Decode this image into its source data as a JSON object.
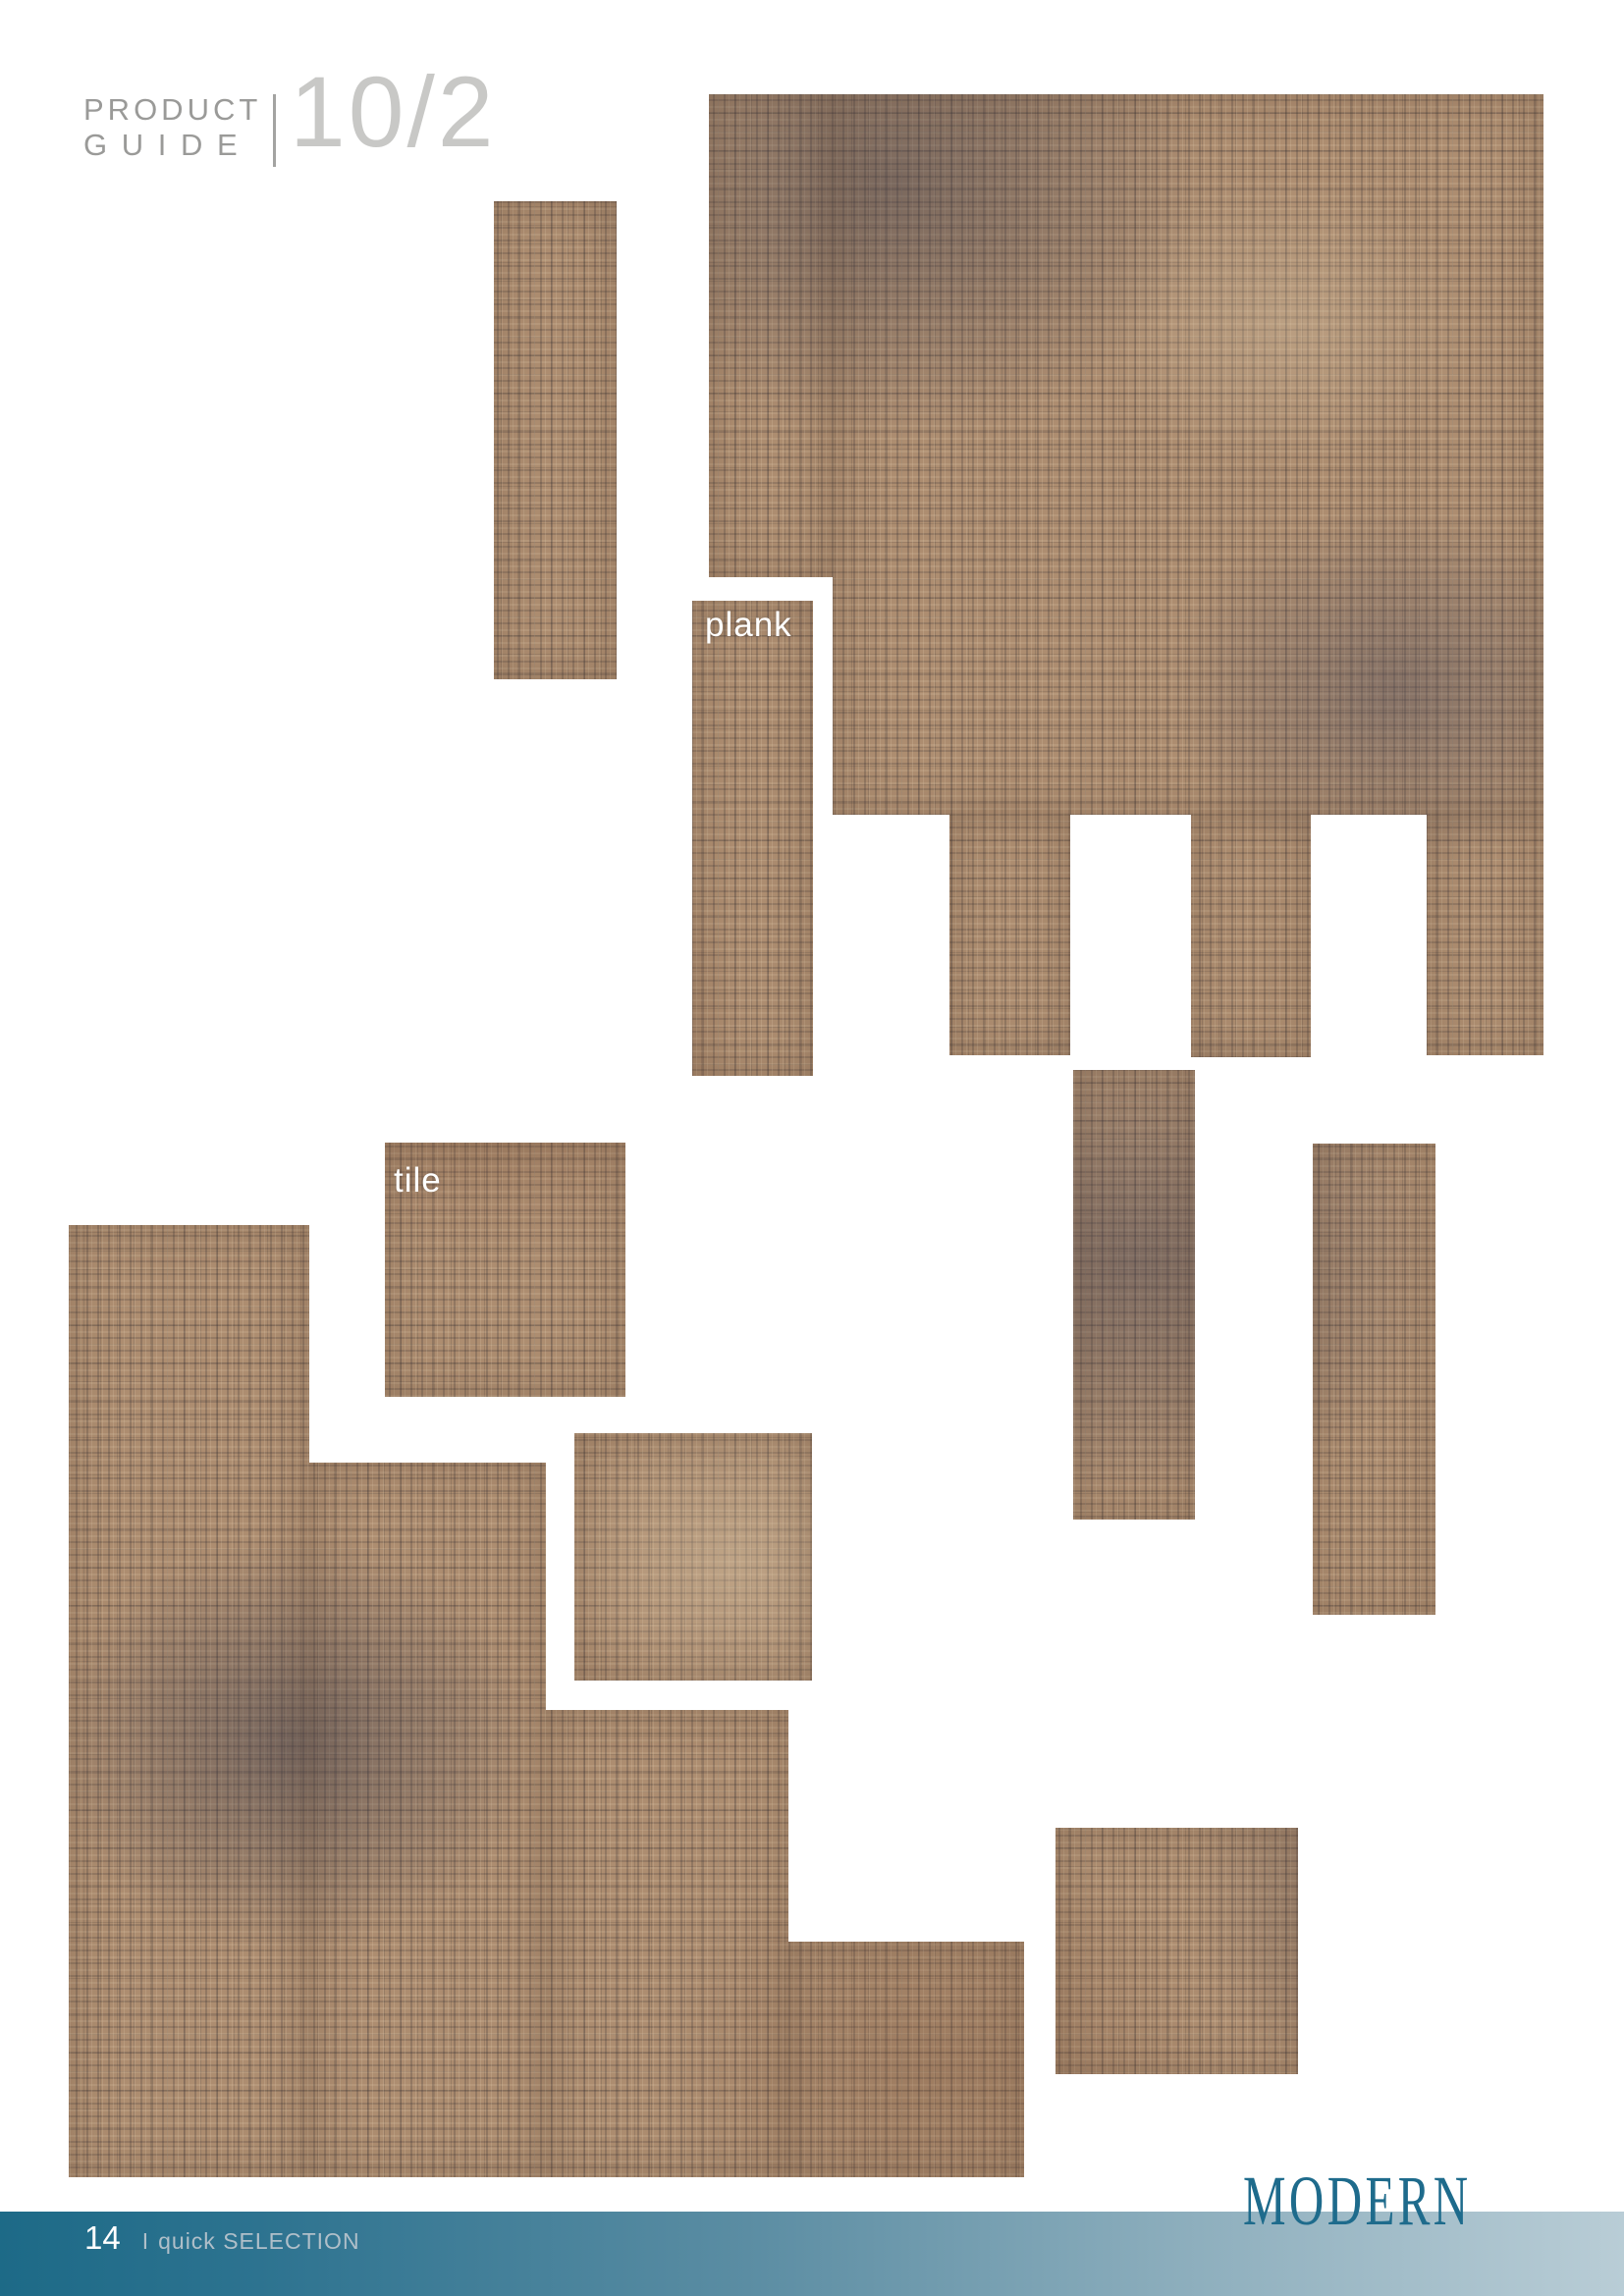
{
  "header": {
    "kicker_line1": "PRODUCT",
    "kicker_line2": "G U I D E",
    "issue": "10/2",
    "kicker_color": "#9a9a98",
    "issue_color": "#c8c8c6"
  },
  "labels": {
    "plank": "plank",
    "tile": "tile",
    "label_color": "#ffffff"
  },
  "carpet": {
    "base_color": "#ad8d70",
    "dark_patch_color": "#4e4d58",
    "rust_color": "#7a4a33",
    "highlight_color": "#d8c6a8"
  },
  "footer": {
    "page_number": "14",
    "separator": "I",
    "section": "quick SELECTION",
    "brand": "MODERN",
    "bar_gradient_start": "#1d6a87",
    "bar_gradient_end": "#b9cdd6",
    "brand_color": "#1e6b8c",
    "page_number_color": "#ffffff",
    "section_color": "#b0bfc9"
  }
}
